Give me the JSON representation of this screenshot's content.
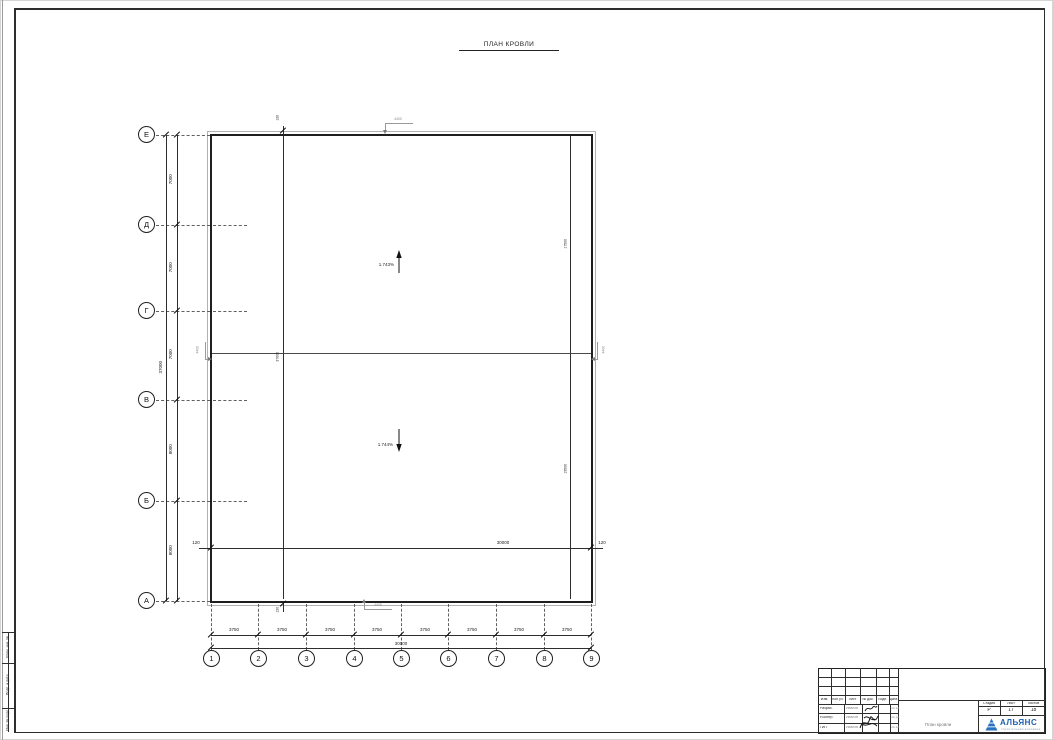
{
  "page": {
    "title": "ПЛАН КРОВЛИ"
  },
  "axes": {
    "rows": [
      "Е",
      "Д",
      "Г",
      "В",
      "Б",
      "А"
    ],
    "cols": [
      "1",
      "2",
      "3",
      "4",
      "5",
      "6",
      "7",
      "8",
      "9"
    ]
  },
  "dims": {
    "left_bays": [
      "7000",
      "7000",
      "7000",
      "8000",
      "8000"
    ],
    "left_total": "37000",
    "bottom_bays": [
      "3750",
      "3750",
      "3750",
      "3750",
      "3750",
      "3750",
      "3750",
      "3750"
    ],
    "bottom_total": "30000",
    "inner_left": "120",
    "inner_total": "30000",
    "inner_right": "120",
    "offset_top": "120",
    "offset_bottom": "120",
    "col_line_total": "37000",
    "right_upper": "17500",
    "right_lower": "19500"
  },
  "slopes": {
    "upper": "1.743%",
    "lower": "1.744%"
  },
  "marks": {
    "top": "4400",
    "bottom": "4400",
    "left": "4400",
    "right": "4400"
  },
  "side_stamp": [
    "Взам. инв. №",
    "Подп. и дата",
    "Инв. № подл."
  ],
  "title_block": {
    "header": [
      "Изм.",
      "Кол.уч.",
      "Лист",
      "№ док.",
      "Подп.",
      "Дата"
    ],
    "rows": [
      {
        "role": "Разраб.",
        "name": "Иванов",
        "date": "03.13"
      },
      {
        "role": "Н.контр.",
        "name": "Иванов",
        "date": "03.13"
      },
      {
        "role": "ГИП",
        "name": "Иванов",
        "date": "03.13"
      }
    ],
    "doc_name": "План кровли",
    "stage": {
      "headers": [
        "Стадия",
        "Лист",
        "Листов"
      ],
      "values": [
        "Р",
        "17",
        "18"
      ]
    },
    "logo": {
      "name": "АЛЬЯНС",
      "subtitle": "строительная компания"
    },
    "colors": {
      "logo_blue": "#1b5fae",
      "line_black": "#1f1f1f",
      "mark_grey": "#8a8a8a"
    }
  }
}
